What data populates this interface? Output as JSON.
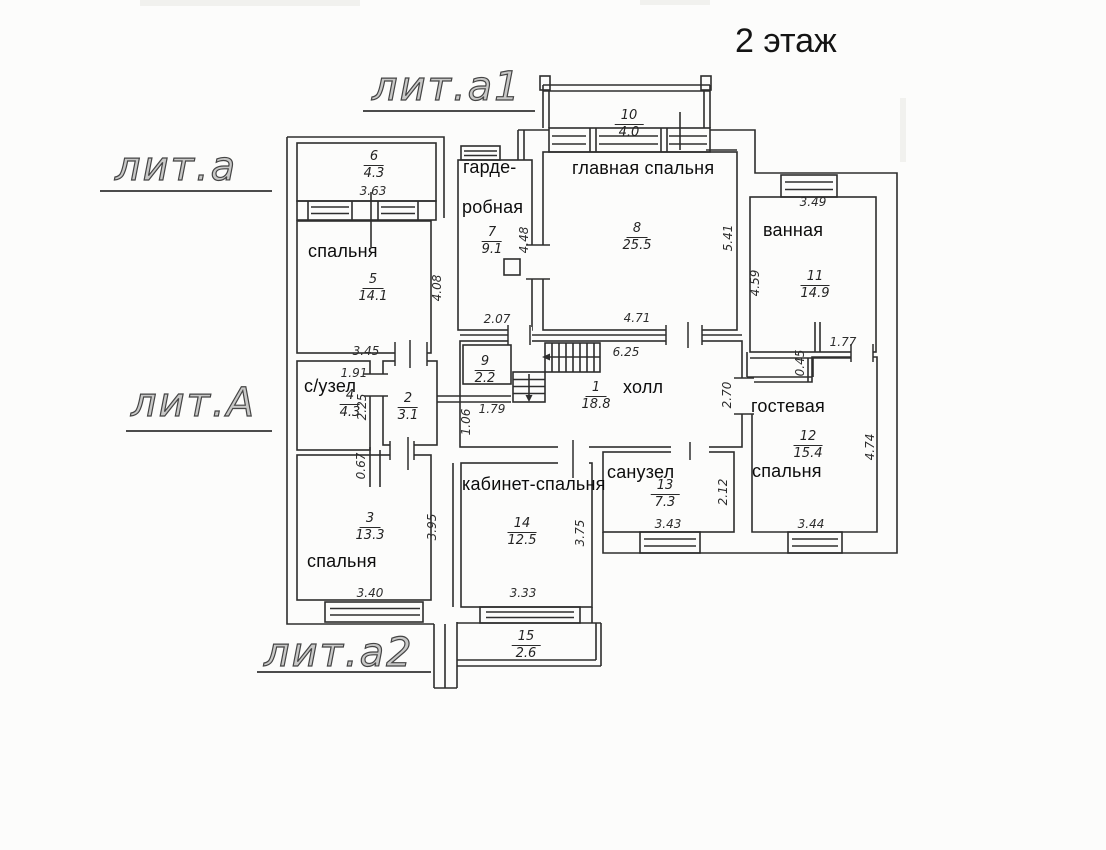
{
  "title": "2 этаж",
  "building_labels": {
    "lit_a1": "лит.а1",
    "lit_a": "лит.а",
    "lit_A": "лит.А",
    "lit_a2": "лит.а2"
  },
  "rooms": {
    "hall": {
      "name": "холл",
      "number": "1",
      "area": "18.8"
    },
    "room2": {
      "number": "2",
      "area": "3.1"
    },
    "bedroom3": {
      "name": "спальня",
      "number": "3",
      "area": "13.3"
    },
    "wc4": {
      "name": "с/узел",
      "number": "4",
      "area": "4.3"
    },
    "bedroom5": {
      "name": "спальня",
      "number": "5",
      "area": "14.1"
    },
    "balcony6": {
      "number": "6",
      "area": "4.3"
    },
    "wardrobe7": {
      "name_line1": "гарде-",
      "name_line2": "робная",
      "number": "7",
      "area": "9.1"
    },
    "main_bedroom8": {
      "name": "главная спальня",
      "number": "8",
      "area": "25.5"
    },
    "closet9": {
      "number": "9",
      "area": "2.2"
    },
    "balcony10": {
      "number": "10",
      "area": "4.0"
    },
    "bathroom11": {
      "name": "ванная",
      "number": "11",
      "area": "14.9"
    },
    "guest_bedroom12": {
      "name_line1": "гостевая",
      "name_line2": "спальня",
      "number": "12",
      "area": "15.4"
    },
    "sanuzel13": {
      "name": "санузел",
      "number": "13",
      "area": "7.3"
    },
    "office_bedroom14": {
      "name": "кабинет-спальня",
      "number": "14",
      "area": "12.5"
    },
    "balcony15": {
      "number": "15",
      "area": "2.6"
    }
  },
  "dimensions": {
    "d363": "3.63",
    "d408": "4.08",
    "d345": "3.45",
    "d191": "1.91",
    "d225": "2.25",
    "d106": "1.06",
    "d179": "1.79",
    "d067": "0.67",
    "d395": "3.95",
    "d340": "3.40",
    "d207": "2.07",
    "d448": "4.48",
    "d471": "4.71",
    "d625": "6.25",
    "d541": "5.41",
    "d459": "4.59",
    "d349": "3.49",
    "d177": "1.77",
    "d045": "0.45",
    "d270": "2.70",
    "d212": "2.12",
    "d343": "3.43",
    "d344": "3.44",
    "d474": "4.74",
    "d333": "3.33",
    "d375": "3.75"
  }
}
